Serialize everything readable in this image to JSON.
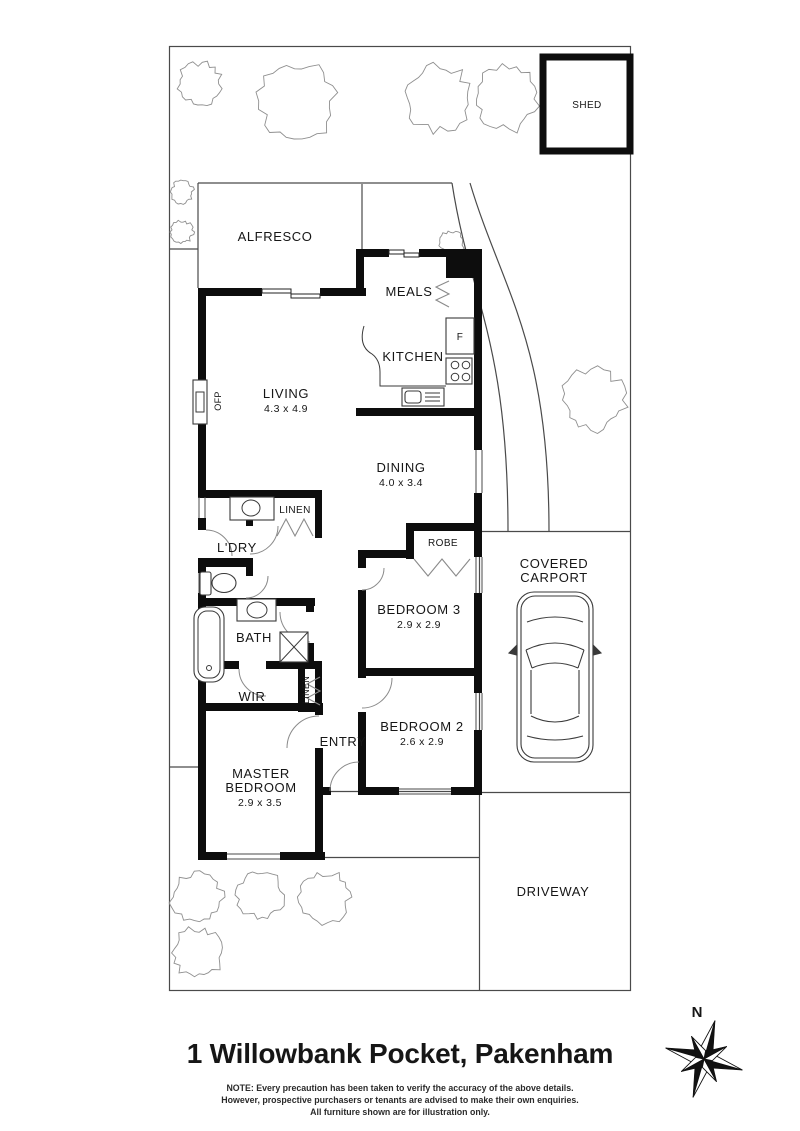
{
  "title": "1 Willowbank Pocket, Pakenham",
  "note_lines": [
    "NOTE: Every precaution has been taken to verify the accuracy of the above details.",
    "However, prospective purchasers or tenants are advised to make their own enquiries.",
    "All furniture shown are for illustration only."
  ],
  "compass_label": "N",
  "rooms": {
    "shed": {
      "label": "SHED"
    },
    "alfresco": {
      "label": "ALFRESCO"
    },
    "meals": {
      "label": "MEALS"
    },
    "kitchen": {
      "label": "KITCHEN",
      "fridge": "F"
    },
    "living": {
      "label": "LIVING",
      "dims": "4.3 x 4.9",
      "fireplace": "OFP"
    },
    "dining": {
      "label": "DINING",
      "dims": "4.0 x 3.4"
    },
    "laundry": {
      "label": "L'DRY"
    },
    "linen_upper": {
      "label": "LINEN"
    },
    "robe": {
      "label": "ROBE"
    },
    "bedroom3": {
      "label": "BEDROOM 3",
      "dims": "2.9 x 2.9"
    },
    "bath": {
      "label": "BATH"
    },
    "wir": {
      "label": "WIR"
    },
    "linen_lower": {
      "label": "LINEN"
    },
    "entry": {
      "label": "ENTRY"
    },
    "bedroom2": {
      "label": "BEDROOM 2",
      "dims": "2.6 x 2.9"
    },
    "master": {
      "line1": "MASTER",
      "line2": "BEDROOM",
      "dims": "2.9 x 3.5"
    },
    "carport": {
      "line1": "COVERED",
      "line2": "CARPORT"
    },
    "driveway": {
      "label": "DRIVEWAY"
    }
  },
  "trees": [
    {
      "cx": 200,
      "cy": 84,
      "r": 23
    },
    {
      "cx": 298,
      "cy": 101,
      "r": 41
    },
    {
      "cx": 437,
      "cy": 98,
      "r": 36
    },
    {
      "cx": 506,
      "cy": 99,
      "r": 34
    },
    {
      "cx": 182,
      "cy": 192,
      "r": 12
    },
    {
      "cx": 182,
      "cy": 232,
      "r": 12
    },
    {
      "cx": 452,
      "cy": 243,
      "r": 13
    },
    {
      "cx": 594,
      "cy": 400,
      "r": 33
    },
    {
      "cx": 197,
      "cy": 897,
      "r": 27
    },
    {
      "cx": 260,
      "cy": 895,
      "r": 25
    },
    {
      "cx": 325,
      "cy": 897,
      "r": 27
    },
    {
      "cx": 197,
      "cy": 953,
      "r": 27
    }
  ],
  "colors": {
    "wall": "#0d0d0d",
    "line": "#4a4a4a",
    "tree": "#8f8f8f"
  }
}
